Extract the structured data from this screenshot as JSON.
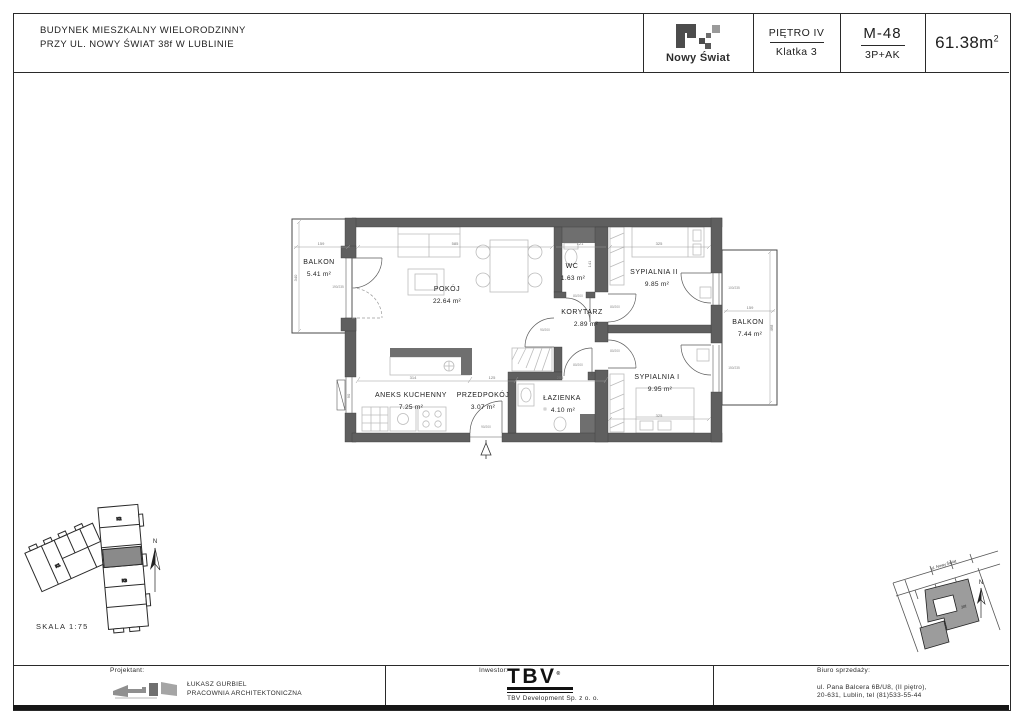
{
  "header": {
    "title1": "BUDYNEK MIESZKALNY WIELORODZINNY",
    "title2": "PRZY UL. NOWY ŚWIAT 38f W LUBLINIE",
    "brand": "Nowy Świat",
    "floor": "PIĘTRO IV",
    "staircase": "Klatka 3",
    "unit": "M-48",
    "unit_type": "3P+AK",
    "area": "61.38m",
    "area_sup": "2"
  },
  "plan": {
    "rooms": [
      {
        "name": "POKÓJ",
        "area": "22.64 m²"
      },
      {
        "name": "ANEKS KUCHENNY",
        "area": "7.25 m²"
      },
      {
        "name": "PRZEDPOKÓJ",
        "area": "3.07 m²"
      },
      {
        "name": "ŁAZIENKA",
        "area": "4.10 m²"
      },
      {
        "name": "WC",
        "area": "1.63 m²"
      },
      {
        "name": "KORYTARZ",
        "area": "2.89 m²"
      },
      {
        "name": "SYPIALNIA II",
        "area": "9.85 m²"
      },
      {
        "name": "SYPIALNIA I",
        "area": "9.95 m²"
      },
      {
        "name": "BALKON",
        "area": "5.41 m²"
      },
      {
        "name": "BALKON",
        "area": "7.44 m²"
      }
    ],
    "dims": {
      "balkon_l_w": "159",
      "balkon_l_h": "340",
      "pokoj_w": "585",
      "wc_w": "121",
      "syp2_w": "325",
      "aneks_w": "314",
      "przedpokoj_w": "125",
      "lazienka_w": "255",
      "syp1_w": "325",
      "balkon_r_w": "159",
      "balkon_r_h": "468",
      "wc_h": "141",
      "kitchen_win": "90",
      "door_balkon": "190/235",
      "door_wc": "80/200",
      "door_pokoj": "90/200",
      "door_laz": "80/200",
      "door_syp2": "80/200",
      "door_syp1": "80/200",
      "door_entry": "90/200",
      "win_syp2": "100/235",
      "win_syp1": "150/235"
    }
  },
  "site": {
    "scale": "SKALA 1:75",
    "north": "N",
    "k1": "K1",
    "k2": "K2",
    "k3": "K3"
  },
  "map": {
    "street": "ul. Nowy Świat",
    "building": "38f",
    "north": "N"
  },
  "footer": {
    "projektant_label": "Projektant:",
    "projektant_name": "ŁUKASZ GURBIEL",
    "projektant_sub": "PRACOWNIA ARCHITEKTONICZNA",
    "inwestor_label": "Inwestor:",
    "inwestor_logo": "TBV",
    "inwestor_reg": "®",
    "inwestor_sub": "TBV  Development Sp. z o. o.",
    "biuro_label": "Biuro sprzedaży:",
    "biuro_line1": "ul. Pana Balcera 6B/U8, (II piętro),",
    "biuro_line2": "20-631, Lublin, tel (81)533-55-44"
  }
}
